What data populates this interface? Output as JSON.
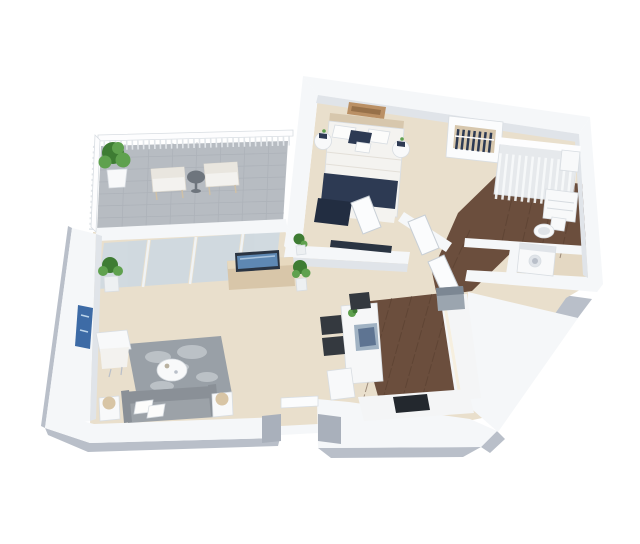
{
  "meta": {
    "title": "3D isometric apartment floor plan render",
    "style": "photoreal 3d dollhouse view, white background"
  },
  "colors": {
    "background": "#ffffff",
    "wall_top": "#f5f7f9",
    "wall_bright": "#fdfdfe",
    "wall_face": "#e0e4e9",
    "wall_face_dark": "#cdd3da",
    "slab_shadow": "#b9bfc9",
    "slab_shadow_dark": "#a9b0bb",
    "floor_main": "#e9dfcc",
    "floor_warm": "#e4d8c3",
    "terrace_tile": "#b7bcc2",
    "tile_line": "#a8aeb5",
    "wood_floor": "#6b4e3d",
    "wood_line": "#543c2d",
    "glass": "#ccd9e3",
    "glass_frame": "#f0f3f5",
    "rail_post": "#e2e6ea",
    "navy": "#2d3a53",
    "navy_dark": "#222d41",
    "duvet": "#f4f3f0",
    "pillow_white": "#fcfcfb",
    "headboard": "#d7c7ad",
    "art_tan": "#ba9065",
    "art_tan_dark": "#97714a",
    "art_blue": "#3d6ba6",
    "art_blue_light": "#bcd4ea",
    "rug": "#99a0a7",
    "rug_light": "#c7ccd1",
    "sofa": "#9ca2a8",
    "sofa_dark": "#8a9097",
    "lamp_shade": "#d8c5a5",
    "fixture_white": "#f8f9fa",
    "fixture_edge": "#d6dbe0",
    "coffee_decor": "#b9b1a0",
    "sideboard": "#d8c6a9",
    "sideboard_top": "#e7d9bf",
    "tv_frame": "#2a3442",
    "tv_screen": "#5e88b3",
    "plant_green": "#3e7c33",
    "plant_green_light": "#5fa14e",
    "plant_pot": "#edf0f2",
    "island": "#f6f7f8",
    "sink_rim": "#a0b2c3",
    "sink_basin": "#5e7492",
    "stool_dark": "#34393f",
    "counter": "#f4f5f6",
    "counter_warm": "#f7efdd",
    "cooktop": "#23282e",
    "appliance": "#9ba5af",
    "appliance_dark": "#7c8793",
    "shower_base": "#e6e9ec",
    "shower_stripe": "#f8fafb",
    "chair_frame": "#cfc0a6",
    "terrace_chair": "#f3f2ef",
    "terrace_chair_back": "#e9e6df",
    "side_table": "#6e757d",
    "door_white": "#fbfcfd",
    "door_edge": "#c8cfd6"
  },
  "rooms": [
    {
      "id": "terrace",
      "label": "Terrace",
      "floor": "grey tile",
      "furniture": [
        "potted-plant",
        "lounge-chair",
        "lounge-chair",
        "side-table",
        "railing",
        "sliding-glass-doors"
      ]
    },
    {
      "id": "bedroom",
      "label": "Bedroom",
      "floor": "beige",
      "furniture": [
        "double-bed",
        "navy-throw",
        "nightstand",
        "nightstand",
        "wall-art",
        "wardrobe-shelf",
        "wall-tv"
      ]
    },
    {
      "id": "bathroom",
      "label": "Bathroom",
      "floor": "dark wood",
      "furniture": [
        "walk-in-shower",
        "vanity-cabinet",
        "toilet"
      ]
    },
    {
      "id": "laundry",
      "label": "Laundry nook",
      "floor": "beige",
      "furniture": [
        "washing-machine"
      ]
    },
    {
      "id": "hallway",
      "label": "Hallway",
      "floor": "beige + wood",
      "furniture": [
        "door",
        "door",
        "door"
      ]
    },
    {
      "id": "living-room",
      "label": "Living room",
      "floor": "beige",
      "furniture": [
        "sofa",
        "throw-pillows",
        "floor-lamp",
        "floor-lamp",
        "armchair",
        "coffee-table",
        "area-rug",
        "media-sideboard",
        "tv",
        "potted-plant",
        "potted-plant",
        "wall-art"
      ]
    },
    {
      "id": "kitchen",
      "label": "Kitchen",
      "floor": "dark wood",
      "furniture": [
        "kitchen-island",
        "sink",
        "bar-stool",
        "bar-stool",
        "bar-stool",
        "l-counter",
        "cooktop",
        "appliance",
        "potted-plant"
      ]
    },
    {
      "id": "entry",
      "label": "Entry",
      "floor": "beige",
      "furniture": [
        "door-opening",
        "threshold"
      ]
    }
  ]
}
